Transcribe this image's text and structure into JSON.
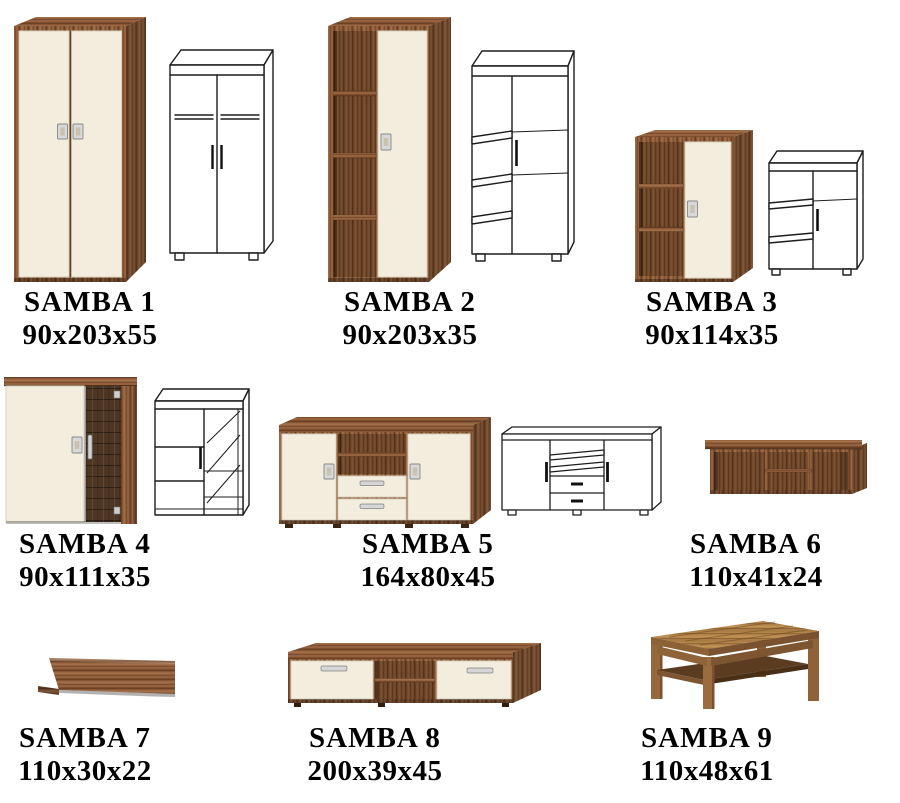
{
  "page": {
    "background": "#ffffff",
    "description": "SAMBA furniture collection catalog sheet with product photos, technical line drawings and dimensions"
  },
  "colors": {
    "wood_walnut": "#8d5c3a",
    "wood_dark_interior": "#6f4628",
    "front_cream": "#f3edde",
    "handle_silver": "#d8d8d8",
    "glass_door": "#4e3624",
    "oak_table": "#b28549",
    "drawing_outline": "#1d1d1d",
    "label_text": "#000000"
  },
  "products": [
    {
      "id": "samba-1",
      "name": "SAMBA 1",
      "dimensions": "90x203x55",
      "kind": "two-door wardrobe",
      "views": [
        "photo",
        "line-drawing"
      ]
    },
    {
      "id": "samba-2",
      "name": "SAMBA 2",
      "dimensions": "90x203x35",
      "kind": "tall unit with open shelves and door",
      "views": [
        "photo",
        "line-drawing"
      ]
    },
    {
      "id": "samba-3",
      "name": "SAMBA 3",
      "dimensions": "90x114x35",
      "kind": "cabinet with open shelves and door",
      "views": [
        "photo",
        "line-drawing"
      ]
    },
    {
      "id": "samba-4",
      "name": "SAMBA 4",
      "dimensions": "90x111x35",
      "kind": "cabinet with glass door",
      "views": [
        "photo",
        "line-drawing"
      ]
    },
    {
      "id": "samba-5",
      "name": "SAMBA 5",
      "dimensions": "164x80x45",
      "kind": "sideboard with drawers",
      "views": [
        "photo",
        "line-drawing"
      ]
    },
    {
      "id": "samba-6",
      "name": "SAMBA 6",
      "dimensions": "110x41x24",
      "kind": "wall shelf unit",
      "views": [
        "photo"
      ]
    },
    {
      "id": "samba-7",
      "name": "SAMBA 7",
      "dimensions": "110x30x22",
      "kind": "wall shelf",
      "views": [
        "photo"
      ]
    },
    {
      "id": "samba-8",
      "name": "SAMBA 8",
      "dimensions": "200x39x45",
      "kind": "tv bench",
      "views": [
        "photo"
      ]
    },
    {
      "id": "samba-9",
      "name": "SAMBA 9",
      "dimensions": "110x48x61",
      "kind": "coffee table",
      "views": [
        "photo"
      ]
    }
  ]
}
